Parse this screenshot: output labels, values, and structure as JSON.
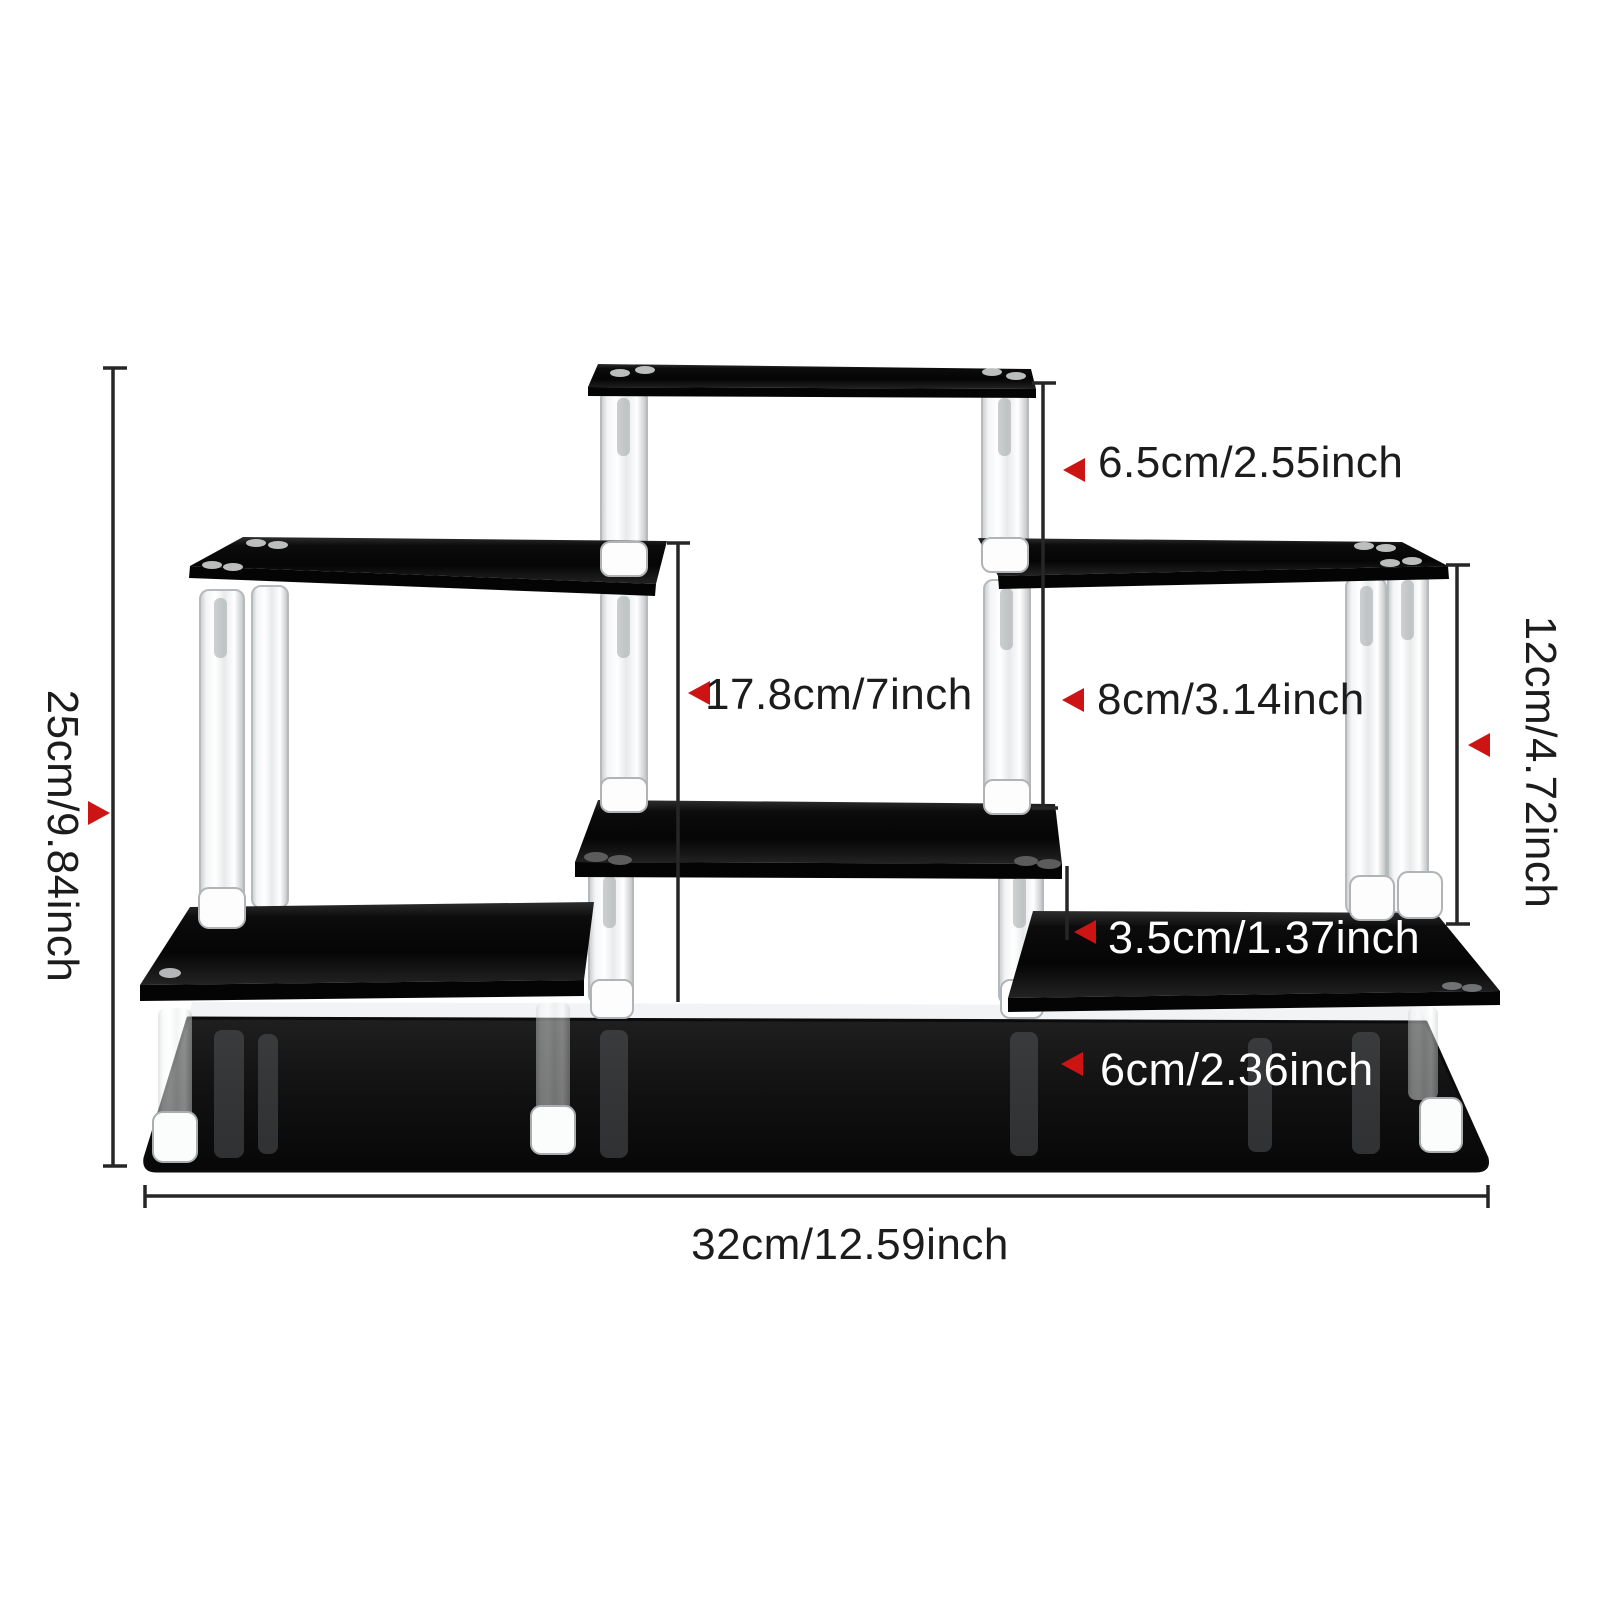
{
  "diagram": {
    "title": "acrylic-display-riser-dimension-diagram",
    "labels": {
      "total_height": "25cm/9.84inch",
      "total_width": "32cm/12.59inch",
      "top_riser_height": "6.5cm/2.55inch",
      "left_column_height": "17.8cm/7inch",
      "right_riser_height": "8cm/3.14inch",
      "right_column_height": "12cm/4.72inch",
      "lower_right_step_height": "3.5cm/1.37inch",
      "base_height": "6cm/2.36inch"
    },
    "colors": {
      "background": "#ffffff",
      "shelf_black": "#0d0d0d",
      "base_black": "#111111",
      "dimension_line": "#262626",
      "label_text": "#1c1c1c",
      "label_text_on_dark": "#ffffff",
      "arrow_red": "#cc1414",
      "pillar_fill": "#f4f6f7",
      "pillar_edge": "#b6babd"
    }
  }
}
